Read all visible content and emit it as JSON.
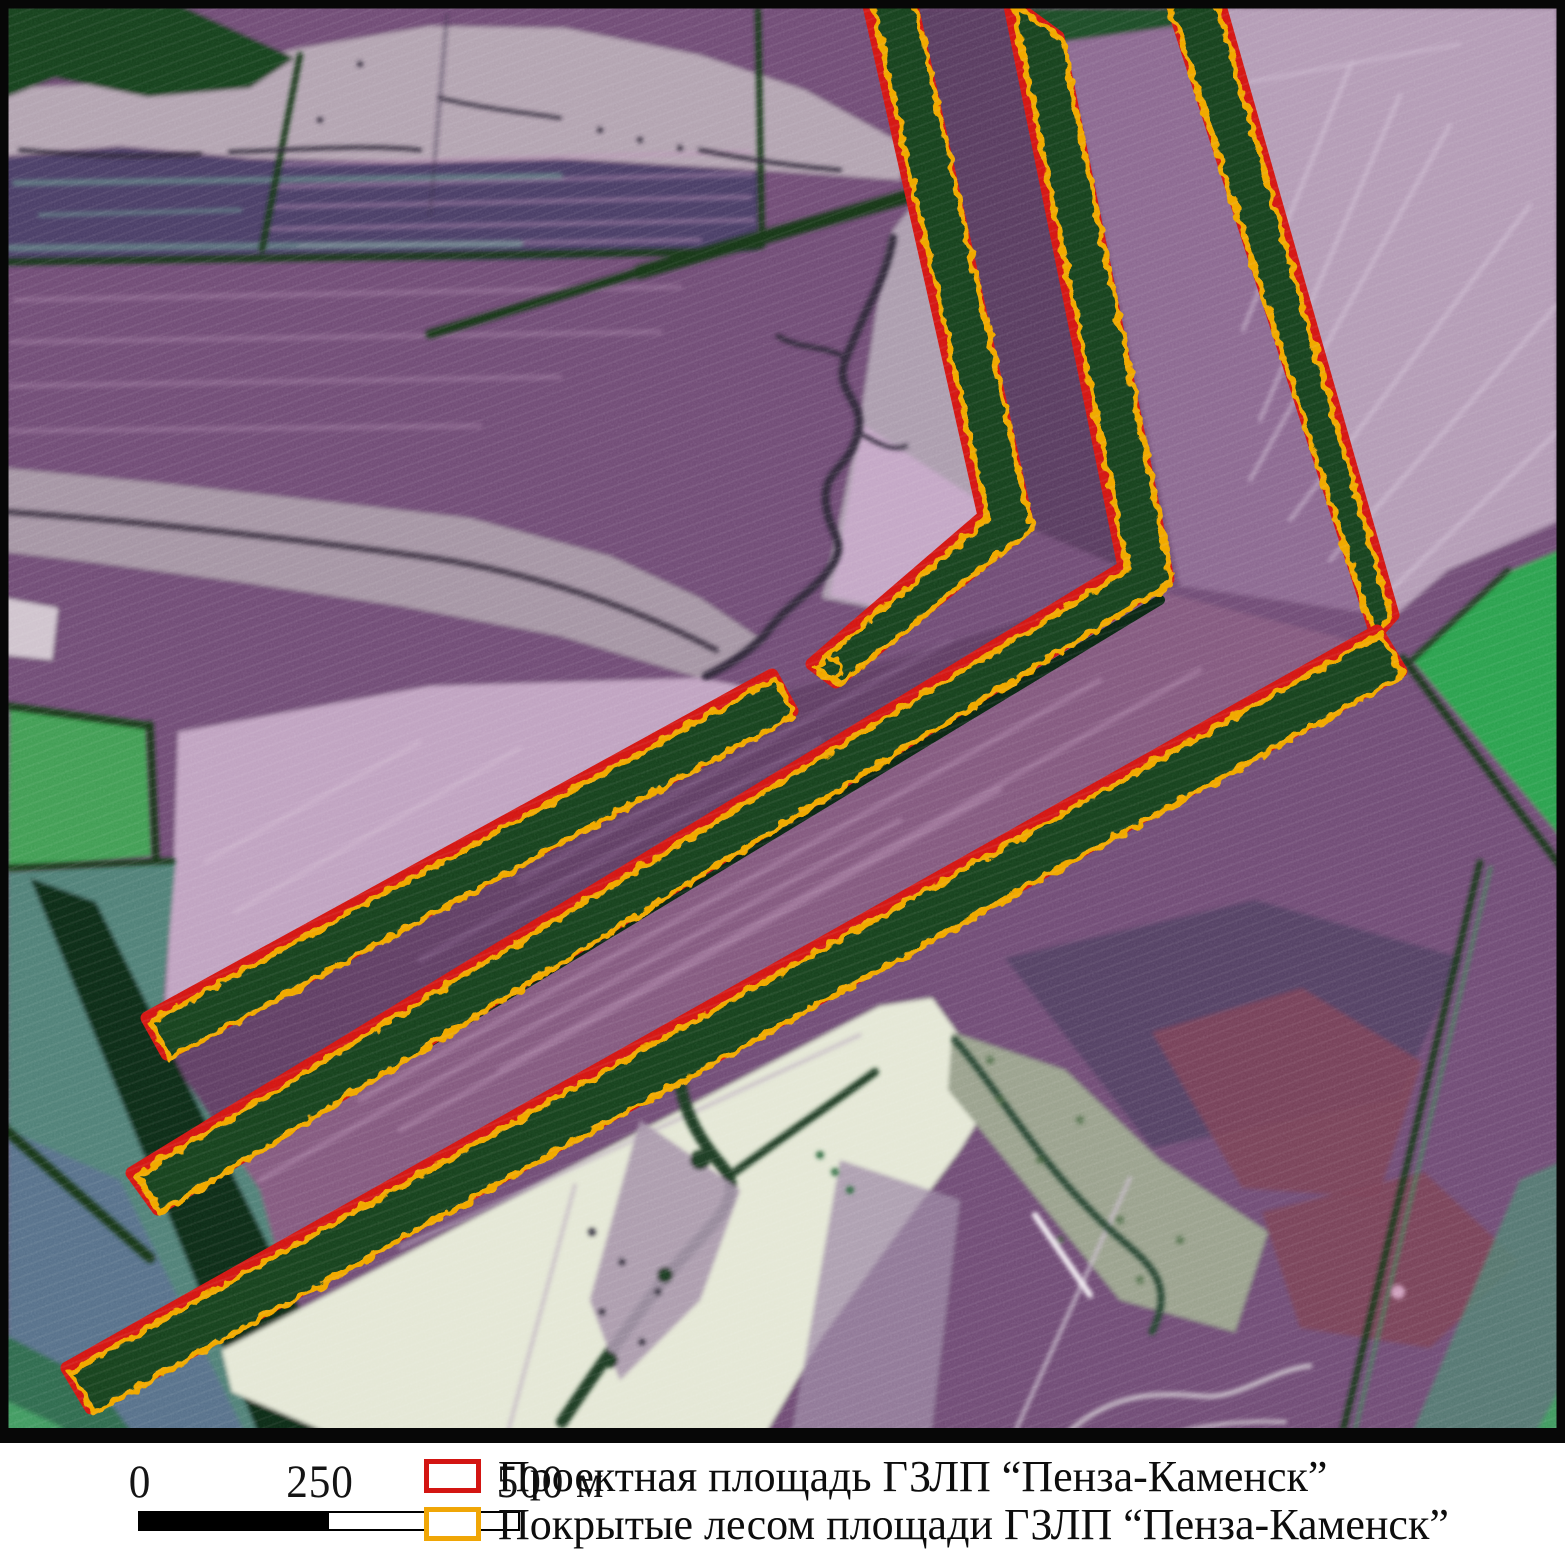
{
  "figure": {
    "kind": "false-color satellite map figure with legend and scale bar",
    "region_labels_visible": false
  },
  "map": {
    "type": "false-color-satellite-imagery",
    "overlays": [
      "project-boundary-red-outline",
      "forested-area-yellow-outline"
    ],
    "shelterbelt_shapes": [
      "vertical-belt-west-with-southwest-arm",
      "vertical-belt-center-with-long-southwest-diagonal",
      "vertical-belt-east-tapered",
      "upper-short-diagonal-belt",
      "lower-long-diagonal-belt"
    ]
  },
  "colors": {
    "project_red": "#d31512",
    "forest_yellow": "#f0a606",
    "belt_green": "#15411d",
    "frame_black": "#070707",
    "base_purple": "#6f4c74",
    "legend_text": "#0d0d0d"
  },
  "scalebar": {
    "labels": [
      "0",
      "250",
      "500 м"
    ],
    "unit": "м",
    "segment_meters": 250,
    "segments": [
      {
        "from": "0",
        "to": "250",
        "fill": "black"
      },
      {
        "from": "250",
        "to": "500",
        "fill": "white"
      }
    ]
  },
  "legend": {
    "items": [
      {
        "swatch": "red-outline-rectangle",
        "color": "#c9201d",
        "label": "Проектная площадь ГЗЛП “Пенза-Каменск”"
      },
      {
        "swatch": "yellow-outline-rectangle",
        "color": "#eda913",
        "label": "Покрытые лесом площади ГЗЛП “Пенза-Каменск”"
      }
    ]
  }
}
